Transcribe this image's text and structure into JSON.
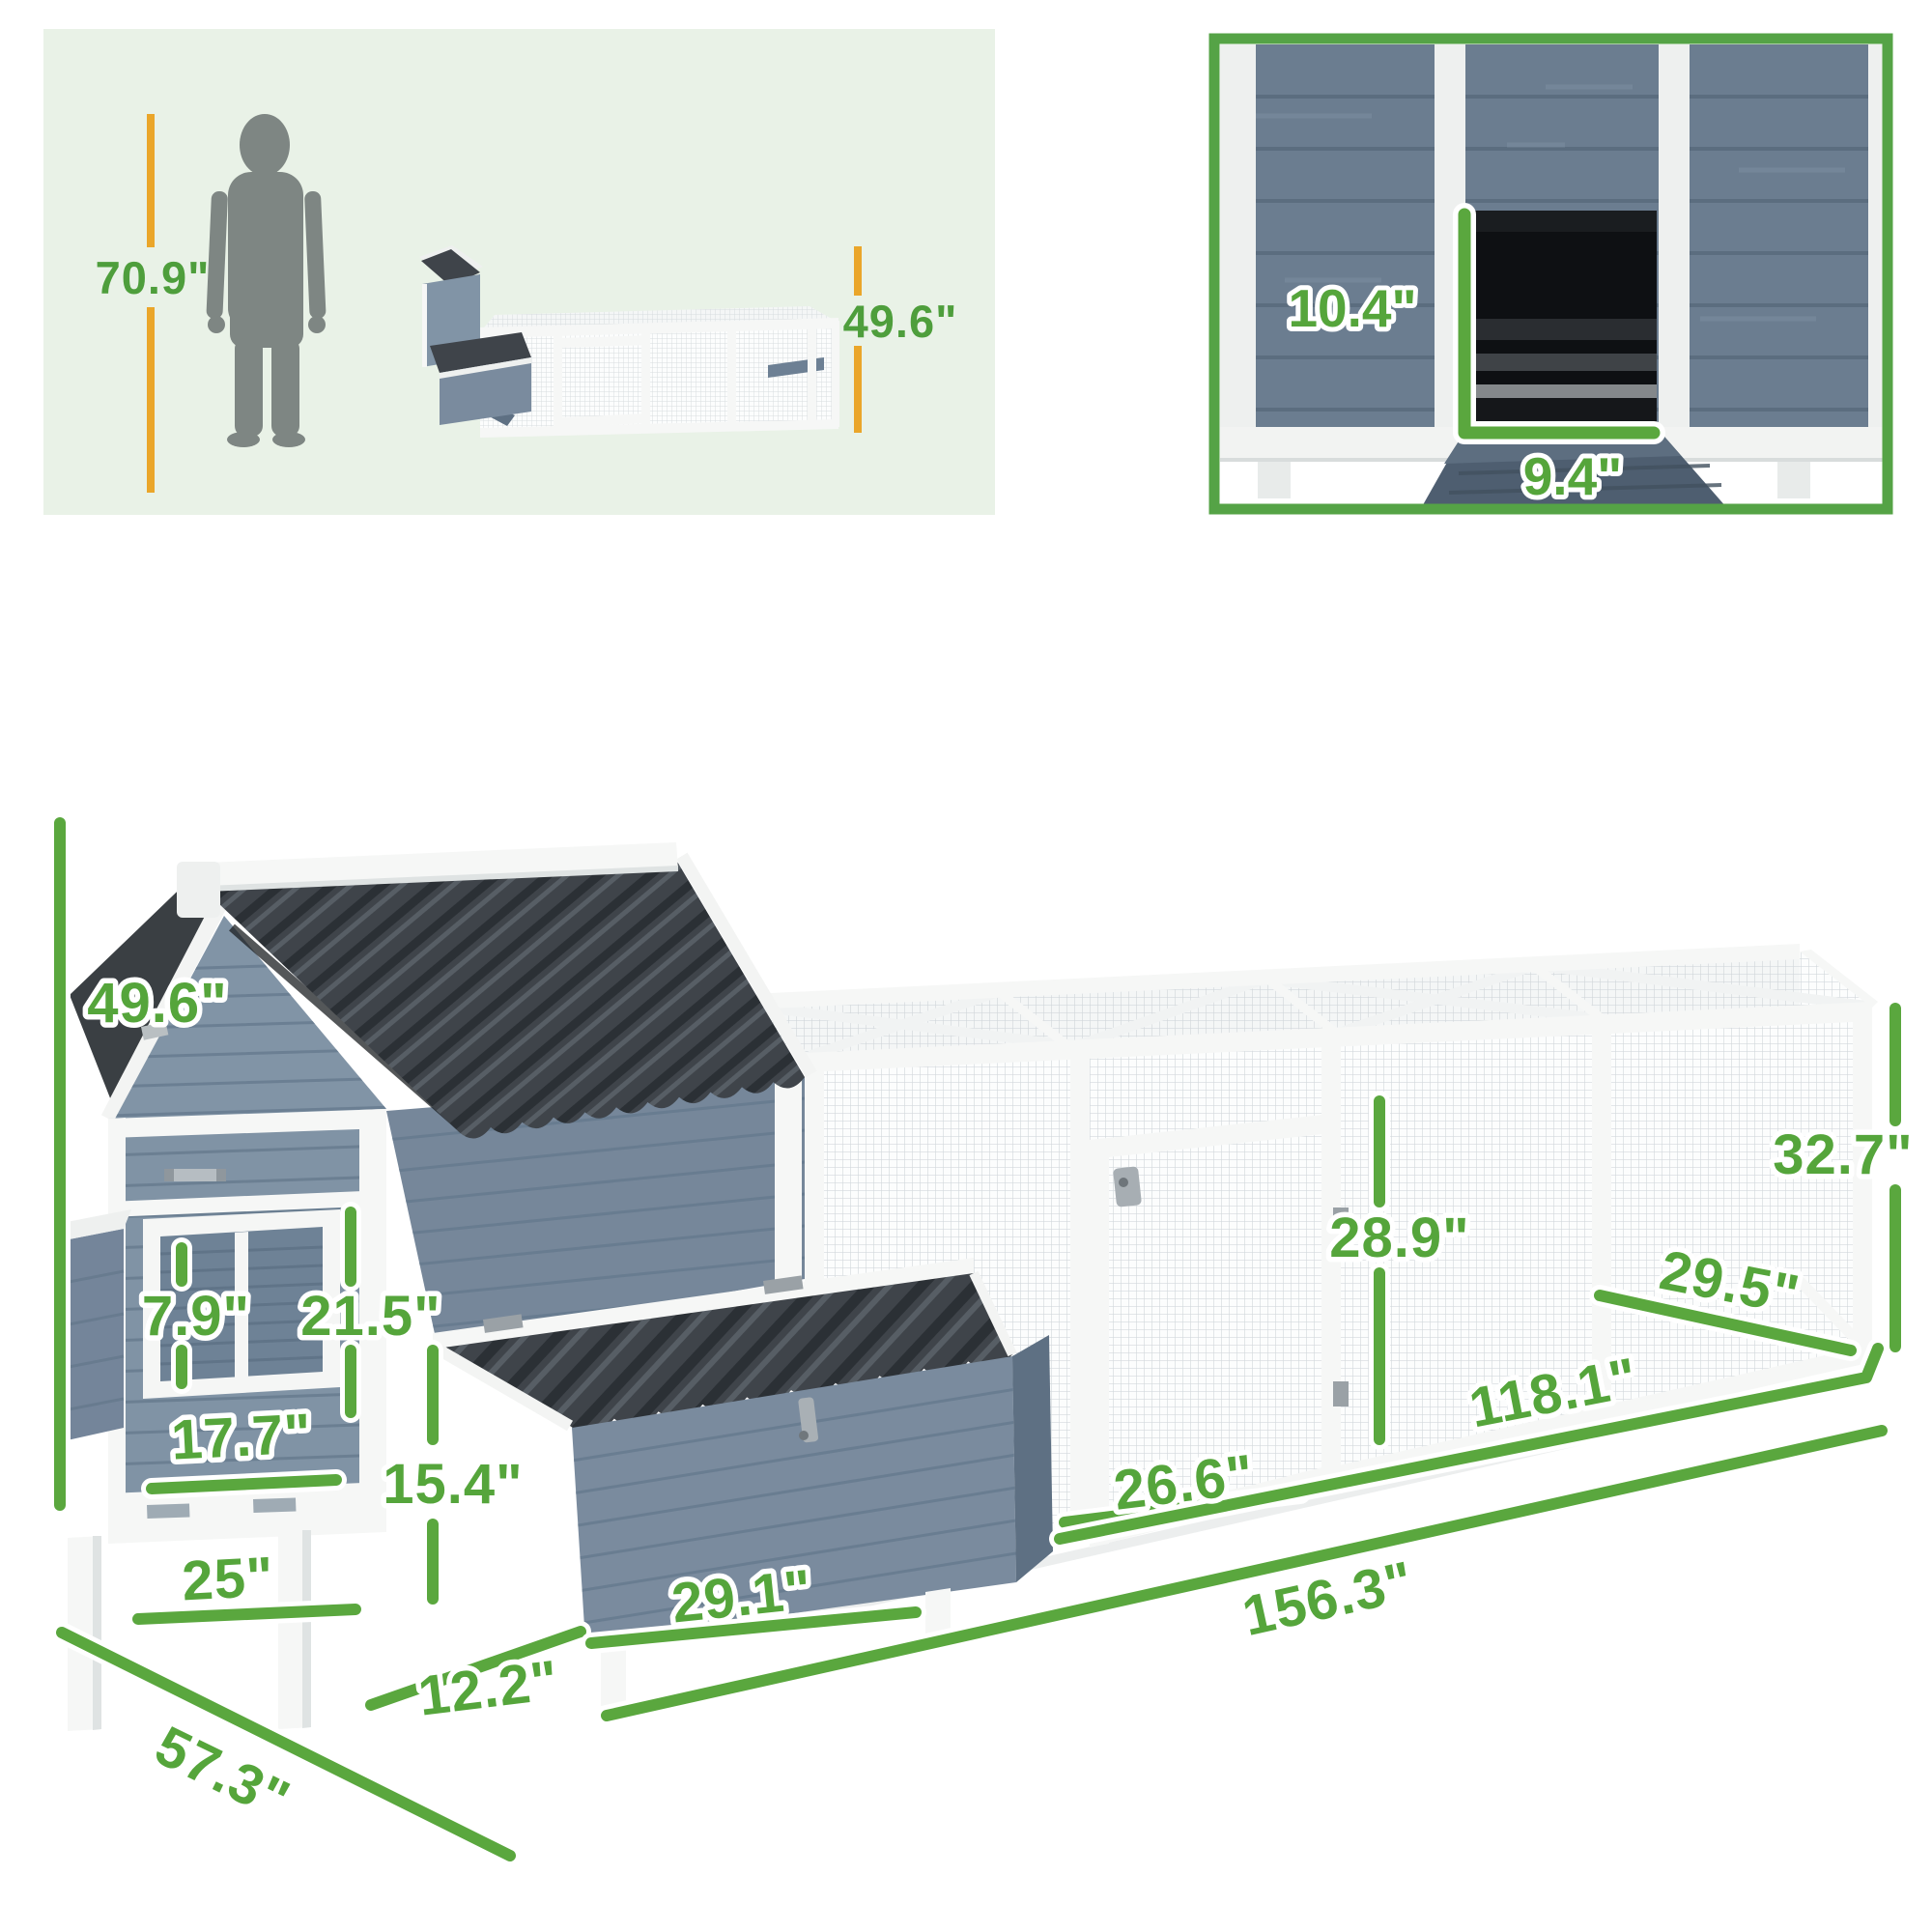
{
  "colors": {
    "dimension_green_text": "#55a53b",
    "dimension_green_line": "#5aa73e",
    "accent_orange": "#eaa62a",
    "scale_panel_bg": "#e9f2e7",
    "detail_panel_border": "#55a346",
    "wood_blue": "#7b8da0",
    "wood_blue_dark": "#5e7083",
    "roof_dark": "#3f444a",
    "trim_white": "#f6f7f6",
    "mesh_gray": "#c9d0d5",
    "silhouette_gray": "#7e8683"
  },
  "scale_panel": {
    "person_height_label": "70.9\"",
    "coop_height_label": "49.6\""
  },
  "door_detail_panel": {
    "pop_door_height_label": "10.4\"",
    "pop_door_width_label": "9.4\""
  },
  "main_diagram": {
    "overall_height_label": "49.6\"",
    "window_height_label": "7.9\"",
    "coop_door_height_label": "21.5\"",
    "window_width_label": "17.7\"",
    "coop_front_width_label": "25\"",
    "nest_box_height_label": "15.4\"",
    "nest_box_depth_label": "12.2\"",
    "overall_depth_label": "57.3\"",
    "nest_box_width_label": "29.1\"",
    "run_door_width_label": "26.6\"",
    "run_door_height_label": "28.9\"",
    "run_depth_label": "29.5\"",
    "run_height_label": "32.7\"",
    "run_length_label": "118.1\"",
    "overall_length_label": "156.3\""
  }
}
